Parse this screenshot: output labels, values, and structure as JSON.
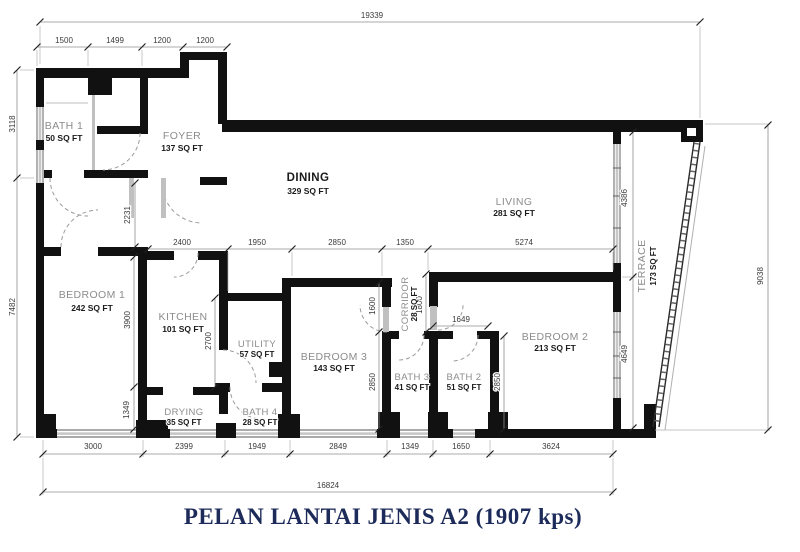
{
  "title": "PELAN LANTAI JENIS A2 (1907 kps)",
  "rooms": {
    "bath1": {
      "name": "BATH 1",
      "area": "50 SQ FT"
    },
    "foyer": {
      "name": "FOYER",
      "area": "137 SQ FT"
    },
    "dining": {
      "name": "DINING",
      "area": "329 SQ FT"
    },
    "living": {
      "name": "LIVING",
      "area": "281 SQ FT"
    },
    "bedroom1": {
      "name": "BEDROOM 1",
      "area": "242 SQ FT"
    },
    "kitchen": {
      "name": "KITCHEN",
      "area": "101 SQ FT"
    },
    "utility": {
      "name": "UTILITY",
      "area": "57 SQ FT"
    },
    "bedroom3": {
      "name": "BEDROOM 3",
      "area": "143 SQ FT"
    },
    "drying": {
      "name": "DRYING",
      "area": "35 SQ FT"
    },
    "bath4": {
      "name": "BATH 4",
      "area": "28 SQ FT"
    },
    "bath3": {
      "name": "BATH 3",
      "area": "41 SQ FT"
    },
    "bath2": {
      "name": "BATH 2",
      "area": "51 SQ FT"
    },
    "bedroom2": {
      "name": "BEDROOM 2",
      "area": "213 SQ FT"
    },
    "corridor": {
      "name": "CORRIDOR",
      "area": "28 SQ FT"
    },
    "terrace": {
      "name": "TERRACE",
      "area": "173 SQ FT"
    }
  },
  "dims": {
    "top_total": "19339",
    "top_row": [
      "1500",
      "1499",
      "1200",
      "1200"
    ],
    "left_col": [
      "3118",
      "7482"
    ],
    "mid_row": [
      "2400",
      "1950",
      "2850",
      "1350",
      "5274"
    ],
    "bottom_row": [
      "3000",
      "2399",
      "1949",
      "2849",
      "1349",
      "1650",
      "3624"
    ],
    "bottom_total": "16824",
    "right_total": "9038",
    "terrace_col": [
      "4386",
      "4649"
    ],
    "hall_height": "2231",
    "kitchen_height": "3900",
    "drying_height": "1349",
    "utility_height": "2700",
    "bedroom3_door": "1600",
    "bath3_height": "2850",
    "corridor_len": "1800",
    "bath2_height": "2850",
    "bedroom2_entry": "1649"
  },
  "colors": {
    "wall": "#111111",
    "title": "#1c2b5a",
    "room_label": "#8c8c8c",
    "area_label": "#1a1a1a",
    "dim": "#3a3a3a",
    "window": "#c7c7c7"
  }
}
